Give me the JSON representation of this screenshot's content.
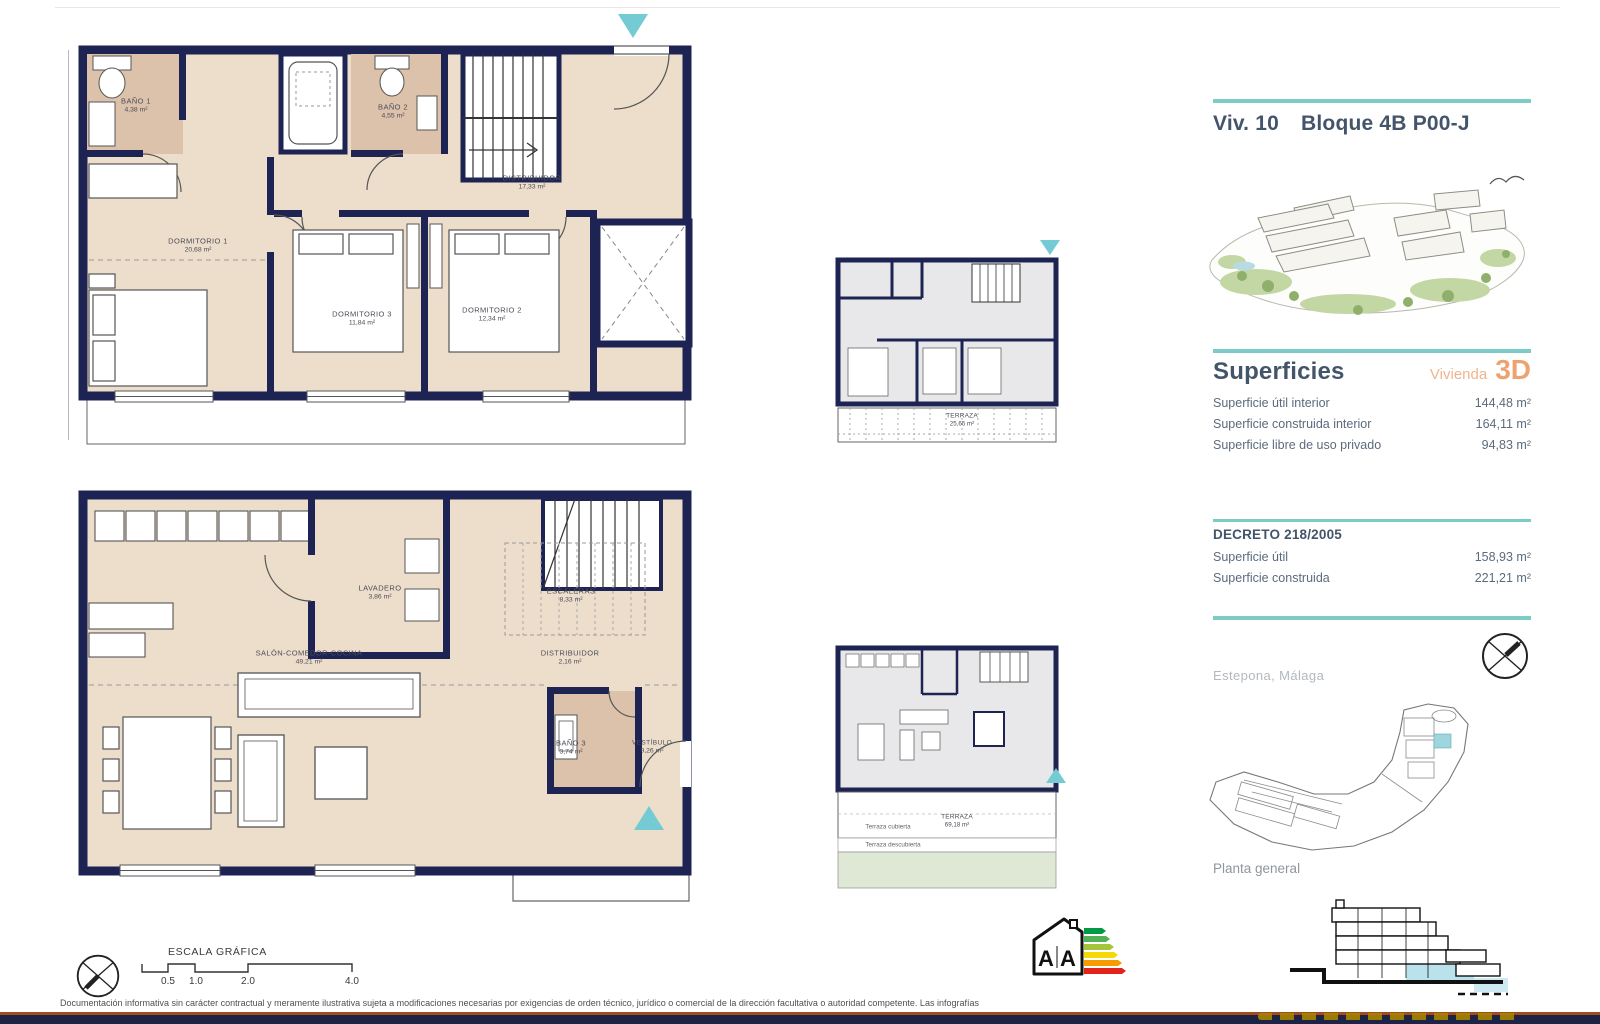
{
  "header": {
    "unit": "Viv. 10",
    "block": "Bloque 4B P00-J"
  },
  "colors": {
    "accent_teal": "#7ccbc6",
    "accent_orange": "#eda371",
    "wall_navy": "#1d2352",
    "floor_beige": "#ecdecb",
    "bath_tan": "#dcc2aa",
    "unit_highlight": "#9fd6de"
  },
  "plans": {
    "upper": {
      "rooms": [
        {
          "name": "BAÑO 1",
          "area": "4,38 m²"
        },
        {
          "name": "BAÑO 2",
          "area": "4,55 m²"
        },
        {
          "name": "DISTRIBUIDOR",
          "area": "17,33 m²"
        },
        {
          "name": "DORMITORIO 1",
          "area": "20,68 m²"
        },
        {
          "name": "DORMITORIO 3",
          "area": "11,84 m²"
        },
        {
          "name": "DORMITORIO 2",
          "area": "12,34 m²"
        }
      ]
    },
    "lower": {
      "rooms": [
        {
          "name": "LAVADERO",
          "area": "3,86 m²"
        },
        {
          "name": "ESCALERAS",
          "area": "8,33 m²"
        },
        {
          "name": "SALÓN-COMEDOR-COCINA",
          "area": "49,21 m²"
        },
        {
          "name": "DISTRIBUIDOR",
          "area": "2,16 m²"
        },
        {
          "name": "BAÑO 3",
          "area": "3,74 m²"
        },
        {
          "name": "VESTÍBULO",
          "area": "9,26 m²"
        }
      ]
    },
    "mini_upper": {
      "terrace": {
        "name": "TERRAZA",
        "area": "25,65 m²"
      }
    },
    "mini_lower": {
      "terrace": {
        "name": "TERRAZA",
        "area": "69,18 m²"
      },
      "covered": "Terraza cubierta",
      "uncovered": "Terraza descubierta"
    }
  },
  "superficies": {
    "heading": "Superficies",
    "subheading": "Vivienda",
    "badge": "3D",
    "rows": [
      {
        "label": "Superficie útil interior",
        "value": "144,48 m²"
      },
      {
        "label": "Superficie construida interior",
        "value": "164,11 m²"
      },
      {
        "label": "Superficie libre de uso privado",
        "value": "94,83 m²"
      }
    ]
  },
  "decreto": {
    "heading": "DECRETO 218/2005",
    "rows": [
      {
        "label": "Superficie útil",
        "value": "158,93 m²"
      },
      {
        "label": "Superficie construida",
        "value": "221,21 m²"
      }
    ]
  },
  "location": {
    "city": "Estepona, Málaga",
    "caption": "Planta general"
  },
  "scalebar": {
    "title": "ESCALA GRÁFICA",
    "ticks": [
      "0.5",
      "1.0",
      "2.0",
      "4.0"
    ]
  },
  "energy": {
    "letters": [
      "A",
      "A"
    ],
    "colors": [
      "#009a44",
      "#52b153",
      "#a3c53a",
      "#f6d809",
      "#f59c00",
      "#e2231a"
    ]
  },
  "disclaimer": {
    "line1": "Documentación informativa sin carácter contractual y meramente ilustrativa sujeta a modificaciones necesarias por exigencias de orden técnico, jurídico o comercial de la dirección facultativa o autoridad competente. Las infografías",
    "line2": "de las fachadas, elementos comunes y restantes espacios son orientativas y podrán ser objeto de verificación o modificación en los proyectos técnicos. El mobiliario de las infografías interiores no está incluido, los acabados"
  }
}
